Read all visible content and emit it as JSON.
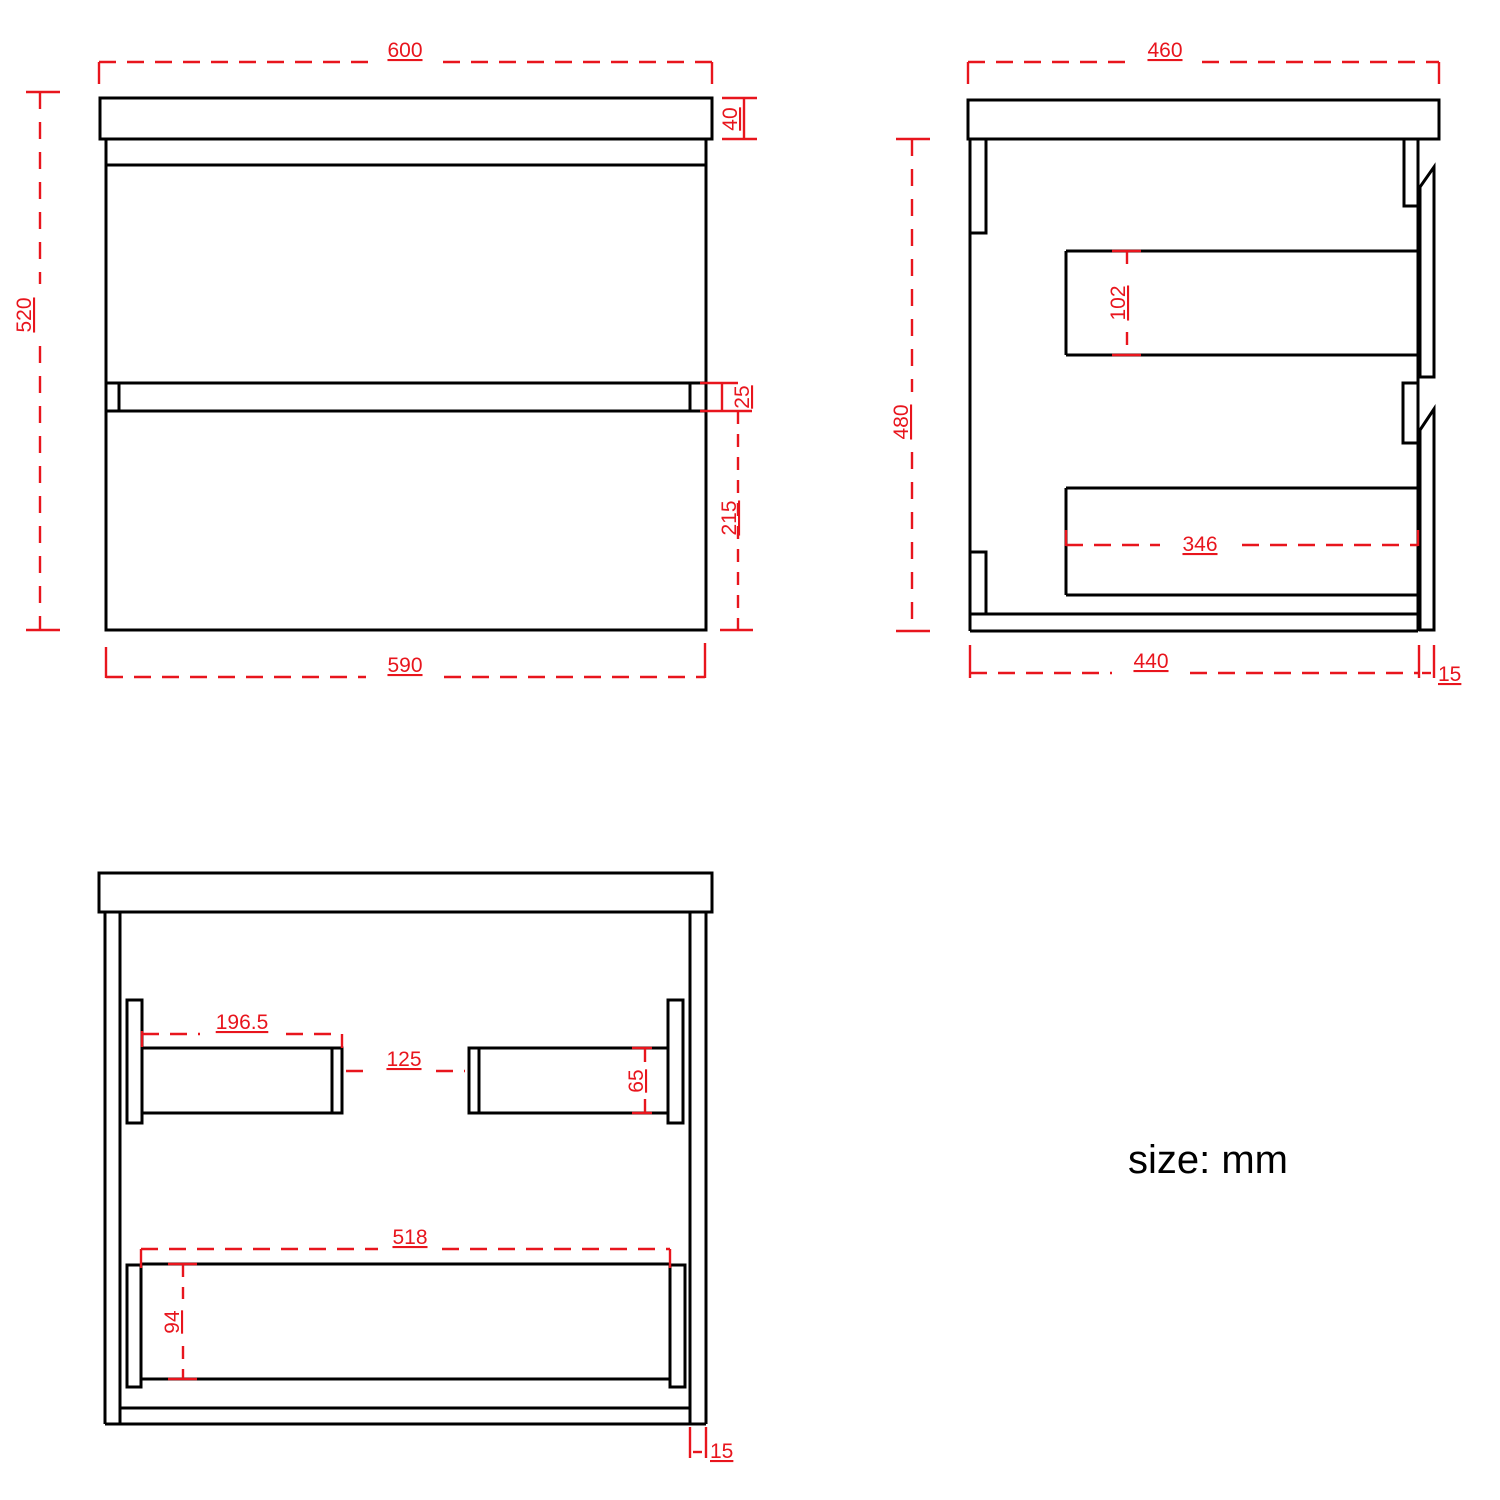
{
  "front": {
    "width_top": "600",
    "top_thickness": "40",
    "height": "520",
    "gap": "25",
    "drawer_height": "215",
    "width_bottom": "590"
  },
  "side": {
    "width_top": "460",
    "height": "480",
    "drawer_box_height": "102",
    "drawer_box_depth": "346",
    "depth_bottom": "440",
    "panel_thickness": "15"
  },
  "bottom": {
    "rail_width": "196.5",
    "rail_gap": "125",
    "rail_height": "65",
    "drawer_box_width": "518",
    "drawer_box_height": "94",
    "wall_thickness": "15"
  },
  "note": {
    "units_label": "size: mm"
  },
  "colors": {
    "line": "#000000",
    "dimension": "#e8151d"
  }
}
